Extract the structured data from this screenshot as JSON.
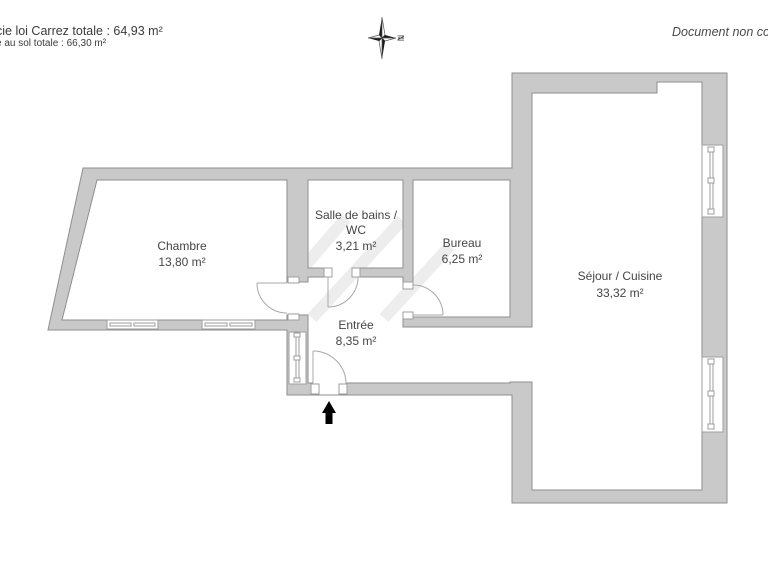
{
  "page": {
    "area_line1": "cie loi Carrez totale : 64,93 m²",
    "area_line2": "e au sol totale : 66,30 m²",
    "disclaimer": "Document non cor",
    "compass_north": "N"
  },
  "rooms": {
    "chambre": {
      "name": "Chambre",
      "area": "13,80 m²"
    },
    "salle_de_bains": {
      "line1": "Salle de bains /",
      "line2": "WC",
      "area": "3,21 m²"
    },
    "bureau": {
      "name": "Bureau",
      "area": "6,25 m²"
    },
    "entree": {
      "name": "Entrée",
      "area": "8,35 m²"
    },
    "sejour": {
      "name": "Séjour / Cuisine",
      "area": "33,32 m²"
    }
  },
  "colors": {
    "wall_fill": "#c9c9c9",
    "wall_line": "#8e8e8e",
    "detail_line": "#9e9e9e",
    "text": "#454545",
    "arrow": "#000000"
  }
}
